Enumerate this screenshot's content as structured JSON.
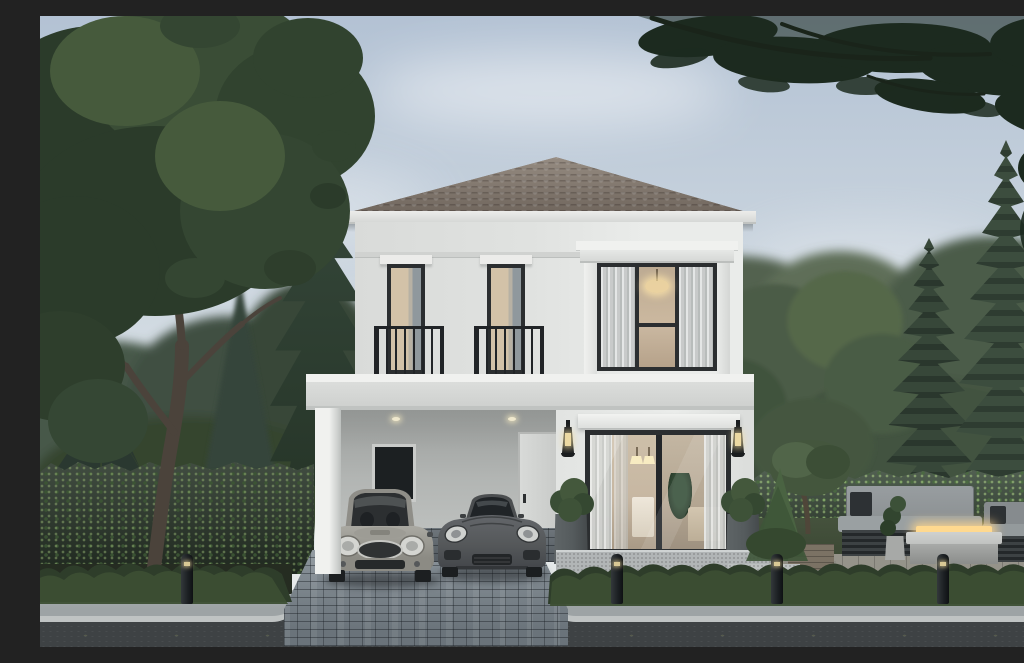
{
  "scene": {
    "title": "Architectural rendering of a modern two-storey detached house",
    "description": "White two-storey house with a grey-brown hipped tile roof, attached carport sheltering a silver Mini hatchback and a dark grey sports coupe, a black-framed sliding glass door with warm lit interior, two juliet-balcony windows upstairs, flanking wall lanterns and planter bushes. Surrounded by a large leafy tree, conifers and tall araucaria pines, trimmed hedges, an outdoor lounge with a fire-pit table, bollard path lights, a paved driveway, sidewalk and asphalt road in front.",
    "setting": "overcast daylight",
    "objects": [
      "sky",
      "clouds",
      "large-tree",
      "conifer",
      "araucaria-pines",
      "overhanging-pine-branches",
      "neighbour-buildings",
      "hedge-wall",
      "house",
      "hipped-tile-roof",
      "juliet-window",
      "bay-window",
      "floor-band",
      "carport",
      "carport-door",
      "carport-window",
      "pillar",
      "sliding-glass-door",
      "wall-lanterns",
      "planter-bushes",
      "terrace-steps",
      "mini-hatchback",
      "sports-coupe",
      "outdoor-sofa",
      "armchair",
      "fire-pit-table",
      "potted-plants",
      "patio",
      "deck-steps",
      "front-shrubs",
      "bollard-lights",
      "driveway",
      "sidewalk",
      "road"
    ]
  },
  "colors": {
    "sky-top": "#b3c2d4",
    "sky-mid": "#ccd6df",
    "sky-low": "#e0e6e9",
    "sky-horizon": "#e9ebea",
    "roof": "#8b8177",
    "roof-dark": "#6f655c",
    "fascia": "#ececea",
    "wall": "#e0e2e0",
    "wall-bright": "#eaecea",
    "band": "#dbdddb",
    "carport-wall": "#b2b5b3",
    "frame-dark": "#2b2e30",
    "railing": "#212427",
    "glass-cool": "#b8bcbe",
    "curtain-warm": "#d3c2a8",
    "interior-warm": "#c7b7a2",
    "lamp-glow": "#ecd9a2",
    "planter": "#555b5d",
    "bush": "#3c4f36",
    "hedge": "#2c392c",
    "hedge-light": "#3f5138",
    "canopy-dark": "#2b3b2a",
    "canopy-mid": "#344632",
    "canopy-light": "#465a3c",
    "conifer": "#2e3f31",
    "araucaria": "#2e3c31",
    "araucaria-light": "#3c4d3e",
    "pine-dark": "#1c2a1f",
    "lawn": "#45523d",
    "trunk": "#4b433b",
    "sidewalk": "#9da3a5",
    "curb": "#bfc3c3",
    "road": "#3e4244",
    "cobble": "#79828a",
    "cobble-dark": "#6a737a",
    "terrace": "#b1b5b6",
    "car-mini": "#95948d",
    "car-coupe": "#55585a",
    "sofa": "#8d9294",
    "sofa-base": "#2e3335",
    "firepit": "#c0c2c0",
    "fire": "#ffd98f",
    "deck": "#7b7264",
    "patio": "#95938a",
    "building-left": "#4d575c",
    "building-right": "#d6d9d6"
  }
}
